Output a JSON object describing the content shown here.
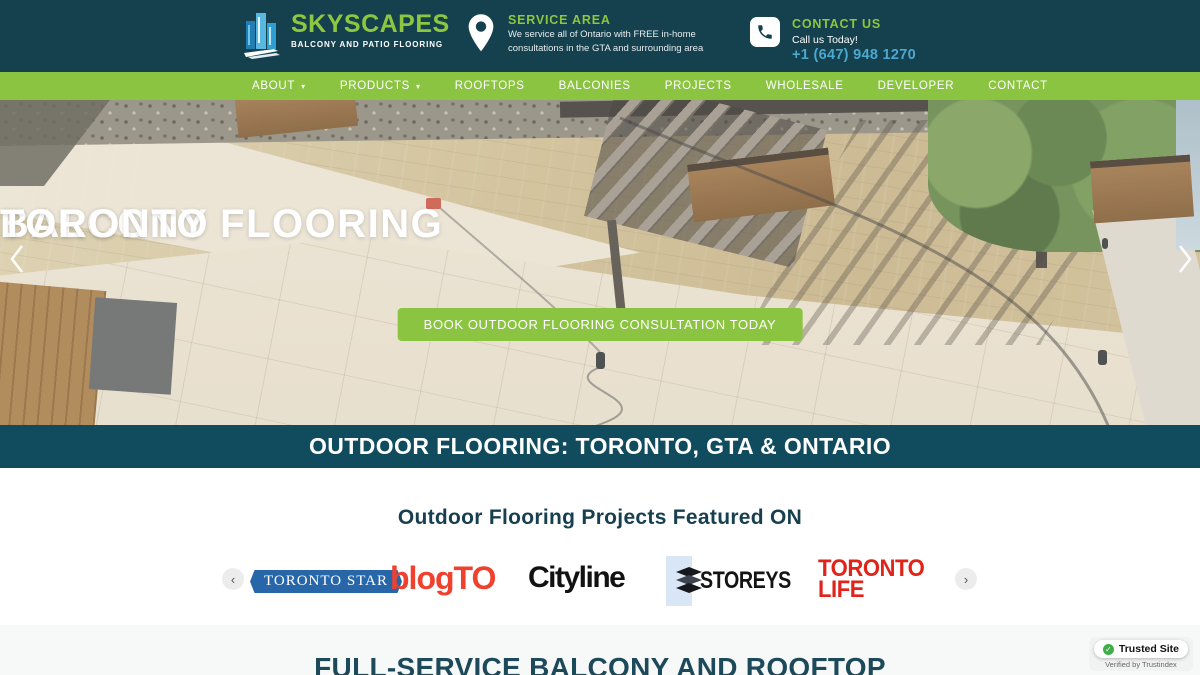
{
  "colors": {
    "header_bg": "#15404e",
    "nav_green": "#8bc441",
    "band_bg": "#114b5e",
    "accent_green": "#8dc63f",
    "phone_blue": "#4ba8cf",
    "heading_teal": "#1c4a5a",
    "star_blue": "#2766a8",
    "blogto_red": "#f0402e",
    "toronto_life_red": "#e0241a",
    "trust_green": "#3fae49"
  },
  "header": {
    "logo": {
      "name": "SKYSCAPES",
      "tagline": "BALCONY AND PATIO FLOORING"
    },
    "service_area": {
      "title": "SERVICE AREA",
      "line1": "We service all of Ontario with FREE in-home",
      "line2": "consultations in the GTA and surrounding area"
    },
    "contact": {
      "title": "CONTACT US",
      "subtitle": "Call us Today!",
      "phone": "+1 (647) 948 1270"
    }
  },
  "nav": {
    "items": [
      {
        "label": "ABOUT",
        "has_dropdown": true
      },
      {
        "label": "PRODUCTS",
        "has_dropdown": true
      },
      {
        "label": "ROOFTOPS",
        "has_dropdown": false
      },
      {
        "label": "BALCONIES",
        "has_dropdown": false
      },
      {
        "label": "PROJECTS",
        "has_dropdown": false
      },
      {
        "label": "WHOLESALE",
        "has_dropdown": false
      },
      {
        "label": "DEVELOPER",
        "has_dropdown": false
      },
      {
        "label": "CONTACT",
        "has_dropdown": false
      }
    ]
  },
  "hero": {
    "title_line1": "BALCONY FLOORING",
    "title_line2": "TORONTO",
    "cta_label": "BOOK OUTDOOR FLOORING CONSULTATION TODAY"
  },
  "band": {
    "title": "OUTDOOR FLOORING: TORONTO, GTA & ONTARIO"
  },
  "featured": {
    "title": "Outdoor Flooring Projects Featured ON",
    "logos": {
      "toronto_star": "TORONTO STAR",
      "blogto": "blogTO",
      "cityline": "Cityline",
      "storeys": "STOREYS",
      "toronto_life_line1": "TORONTO",
      "toronto_life_line2": "LIFE"
    }
  },
  "next_section": {
    "title": "FULL-SERVICE BALCONY AND ROOFTOP"
  },
  "trust_badge": {
    "label": "Trusted Site",
    "subtitle": "Verified by Trustindex"
  }
}
